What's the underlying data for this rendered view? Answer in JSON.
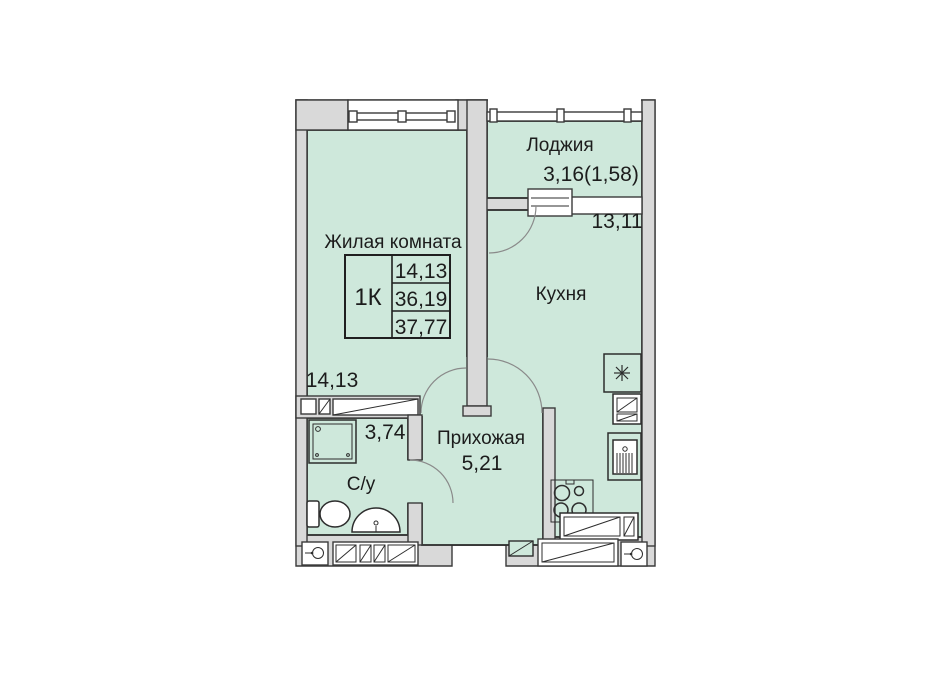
{
  "floorplan": {
    "rooms": {
      "living": {
        "name": "Жилая комната",
        "area": "14,13"
      },
      "kitchen": {
        "name": "Кухня",
        "area": "13,11"
      },
      "hallway": {
        "name": "Прихожая",
        "area": "5,21"
      },
      "bathroom": {
        "name": "С/у",
        "area": "3,74"
      },
      "loggia": {
        "name": "Лоджия",
        "area": "3,16(1,58)"
      }
    },
    "stats": {
      "type": "1К",
      "living_area": "14,13",
      "area_without_loggia": "36,19",
      "total_area": "37,77"
    },
    "colors": {
      "floor": "#cee8db",
      "wall": "#d9d9d9",
      "outline": "#2d2d2d",
      "background": "#ffffff"
    }
  }
}
